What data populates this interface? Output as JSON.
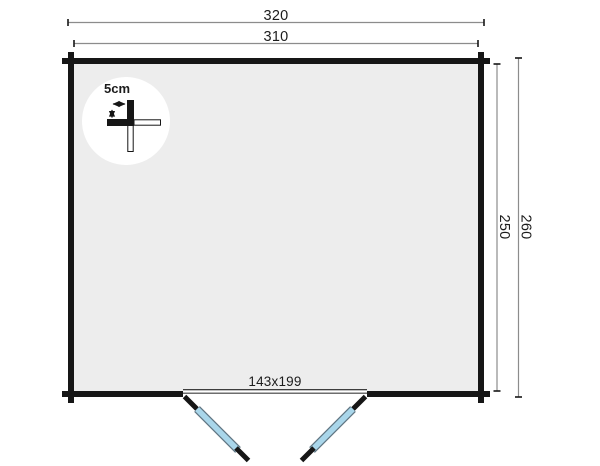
{
  "diagram": {
    "type": "floor-plan-top-view",
    "unit": "cm"
  },
  "labels": {
    "outer_width": "320",
    "inner_width": "310",
    "outer_depth": "260",
    "inner_depth": "250",
    "door_size": "143x199",
    "wall_thickness": "5cm"
  },
  "colors": {
    "background": "#ffffff",
    "floor_fill": "#ededed",
    "wall": "#161616",
    "dimension_line": "#8c8c8c",
    "door_panel": "#a9d6ea",
    "door_panel_outline": "#5f7582",
    "detail_circle": "#ffffff",
    "text": "#1c1c1c"
  }
}
